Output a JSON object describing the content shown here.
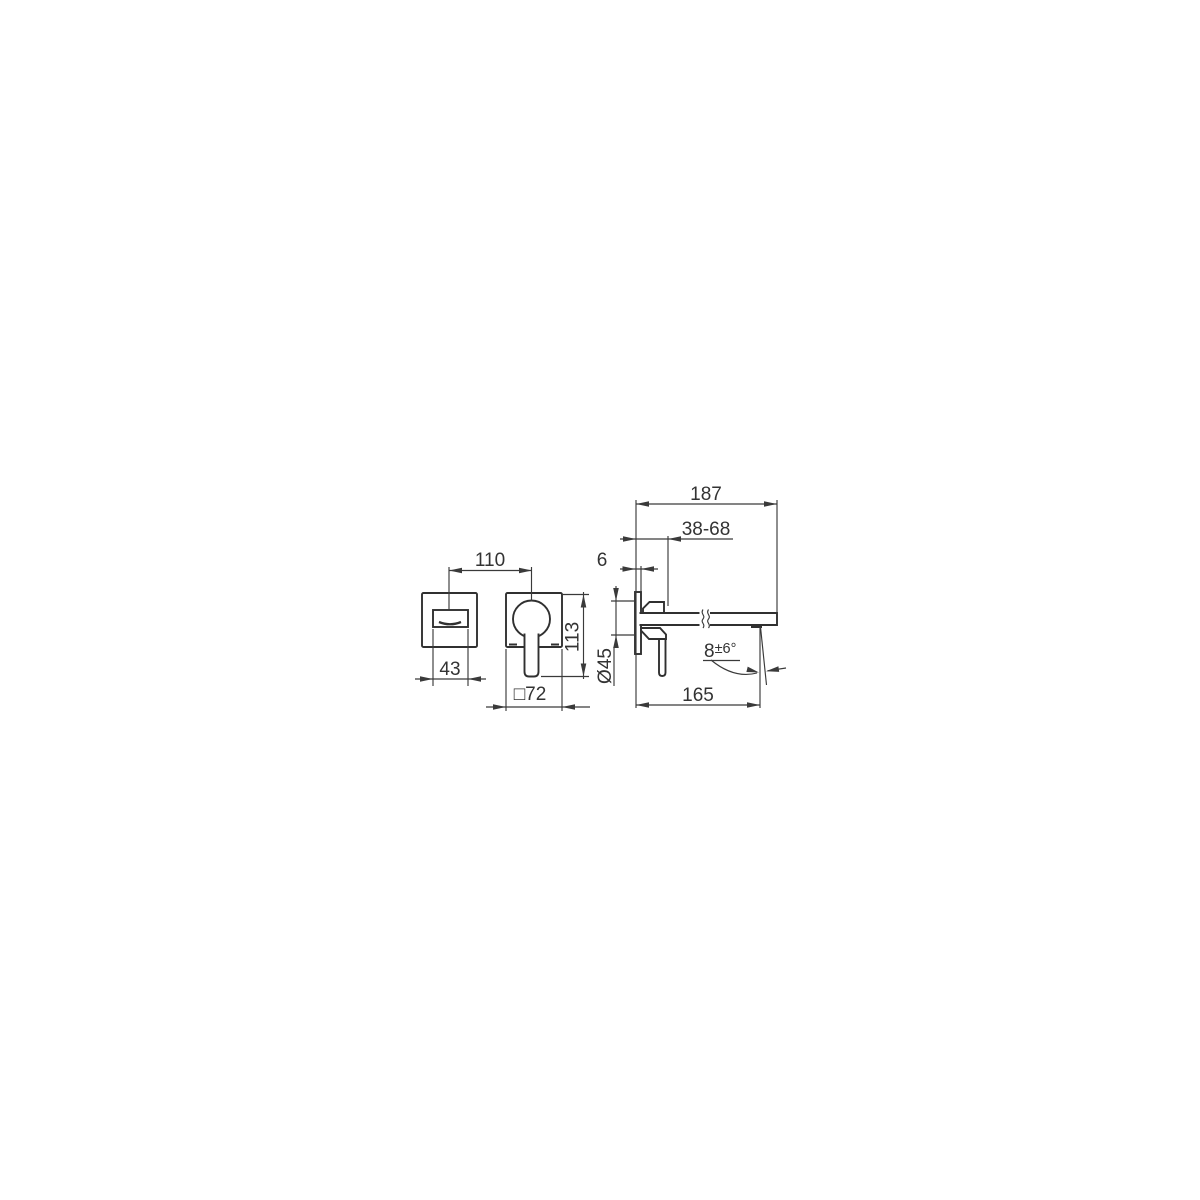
{
  "document": {
    "kind": "technical dimension drawing, wall-mounted single-lever basin mixer",
    "background_color": "#ffffff",
    "line_color": "#3a3a3a",
    "text_color": "#333333"
  },
  "dims": {
    "handle_spacing": "110",
    "spout_width": "43",
    "plate_height": "113",
    "plate_square": "□72",
    "total_projection": "187",
    "mount_depth_range": "38-68",
    "plate_thickness": "6",
    "rough_in_diameter": "Ø45",
    "spout_projection": "165",
    "angle_base": "8",
    "angle_tolerance": "±6°"
  }
}
